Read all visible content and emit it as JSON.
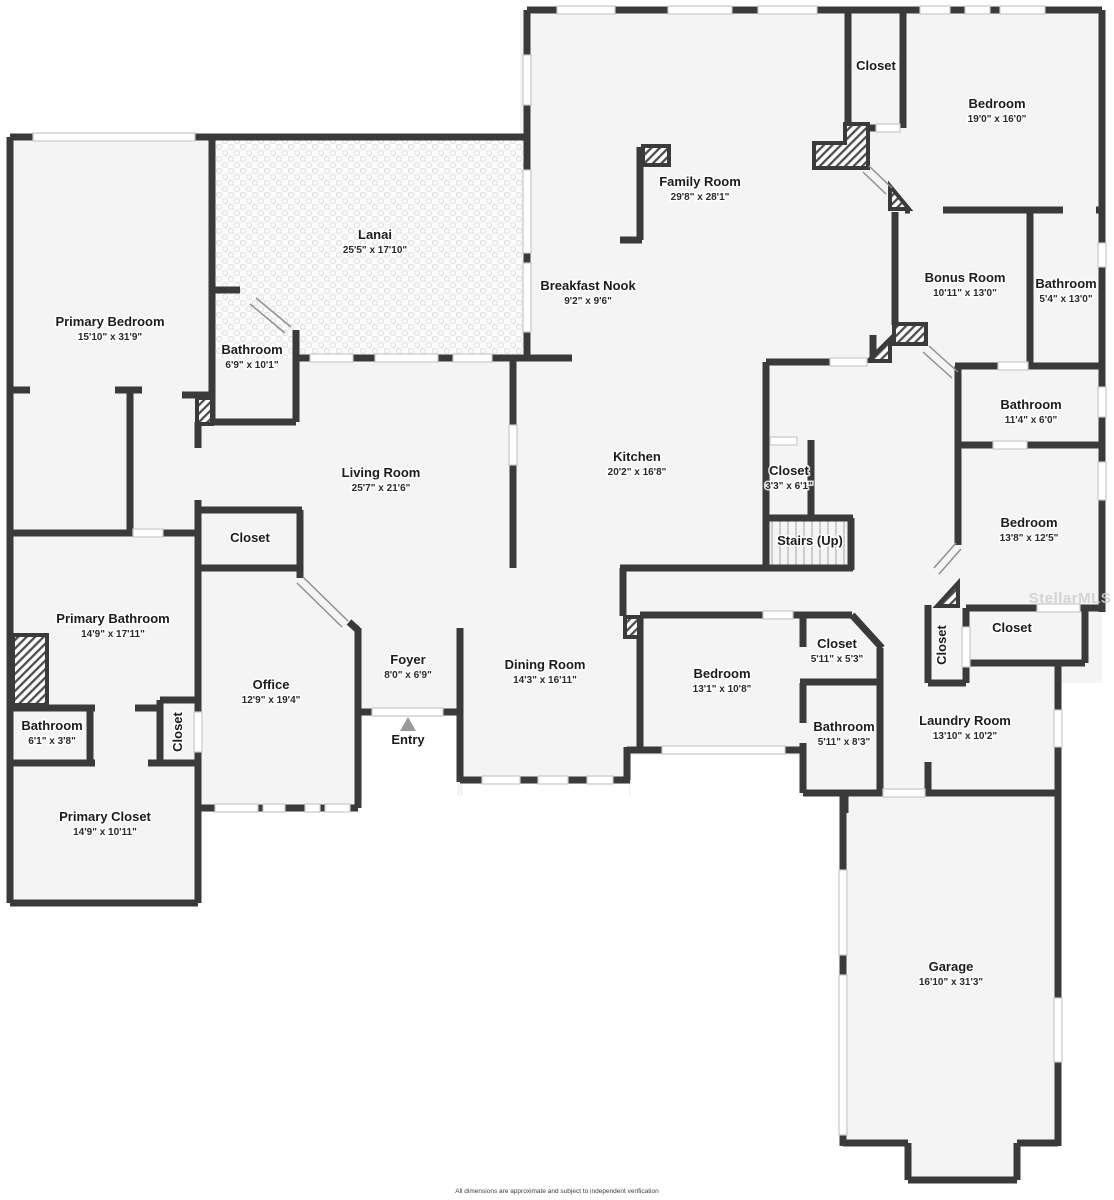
{
  "plan": {
    "wall_color": "#3a3a3a",
    "room_fill": "#f4f4f4",
    "label_color": "#1c1c1c",
    "window_color": "#c8c8c8",
    "entry_arrow_color": "#9a9a9a"
  },
  "rooms": [
    {
      "id": "lanai",
      "name": "Lanai",
      "dims": "25'5\" x 17'10\"",
      "x": 375,
      "y": 239
    },
    {
      "id": "primary-bedroom",
      "name": "Primary Bedroom",
      "dims": "15'10\" x 31'9\"",
      "x": 110,
      "y": 326
    },
    {
      "id": "bathroom-primary-hall",
      "name": "Bathroom",
      "dims": "6'9\" x 10'1\"",
      "x": 252,
      "y": 354
    },
    {
      "id": "family-room",
      "name": "Family Room",
      "dims": "29'8\" x 28'1\"",
      "x": 700,
      "y": 186
    },
    {
      "id": "closet-family",
      "name": "Closet",
      "dims": null,
      "x": 876,
      "y": 70
    },
    {
      "id": "bedroom-1",
      "name": "Bedroom",
      "dims": "19'0\" x 16'0\"",
      "x": 997,
      "y": 108
    },
    {
      "id": "breakfast-nook",
      "name": "Breakfast Nook",
      "dims": "9'2\" x 9'6\"",
      "x": 588,
      "y": 290
    },
    {
      "id": "bonus-room",
      "name": "Bonus Room",
      "dims": "10'11\" x 13'0\"",
      "x": 965,
      "y": 282
    },
    {
      "id": "bathroom-bonus",
      "name": "Bathroom",
      "dims": "5'4\" x 13'0\"",
      "x": 1066,
      "y": 288
    },
    {
      "id": "bathroom-hall",
      "name": "Bathroom",
      "dims": "11'4\" x 6'0\"",
      "x": 1031,
      "y": 409
    },
    {
      "id": "kitchen",
      "name": "Kitchen",
      "dims": "20'2\" x 16'8\"",
      "x": 637,
      "y": 461
    },
    {
      "id": "closet-kitchen",
      "name": "Closet",
      "dims": "3'3\" x 6'1\"",
      "x": 789,
      "y": 475
    },
    {
      "id": "stairs",
      "name": "Stairs (Up)",
      "dims": null,
      "x": 810,
      "y": 545
    },
    {
      "id": "bedroom-2",
      "name": "Bedroom",
      "dims": "13'8\" x 12'5\"",
      "x": 1029,
      "y": 527
    },
    {
      "id": "living-room",
      "name": "Living Room",
      "dims": "25'7\" x 21'6\"",
      "x": 381,
      "y": 477
    },
    {
      "id": "closet-living",
      "name": "Closet",
      "dims": null,
      "x": 250,
      "y": 542
    },
    {
      "id": "primary-bathroom",
      "name": "Primary Bathroom",
      "dims": "14'9\" x 17'11\"",
      "x": 113,
      "y": 623
    },
    {
      "id": "office",
      "name": "Office",
      "dims": "12'9\" x 19'4\"",
      "x": 271,
      "y": 689
    },
    {
      "id": "foyer",
      "name": "Foyer",
      "dims": "8'0\" x 6'9\"",
      "x": 408,
      "y": 664
    },
    {
      "id": "dining-room",
      "name": "Dining Room",
      "dims": "14'3\" x 16'11\"",
      "x": 545,
      "y": 669
    },
    {
      "id": "bedroom-3",
      "name": "Bedroom",
      "dims": "13'1\" x 10'8\"",
      "x": 722,
      "y": 678
    },
    {
      "id": "closet-bedroom-3",
      "name": "Closet",
      "dims": "5'11\" x 5'3\"",
      "x": 837,
      "y": 648
    },
    {
      "id": "closet-hall-vertical",
      "name": "Closet",
      "dims": null,
      "x": 946,
      "y": 645,
      "rotate": -90
    },
    {
      "id": "closet-hall",
      "name": "Closet",
      "dims": null,
      "x": 1012,
      "y": 632
    },
    {
      "id": "bathroom-primary-2",
      "name": "Bathroom",
      "dims": "6'1\" x 3'8\"",
      "x": 52,
      "y": 730
    },
    {
      "id": "closet-office-vertical",
      "name": "Closet",
      "dims": null,
      "x": 182,
      "y": 732,
      "rotate": -90
    },
    {
      "id": "primary-closet",
      "name": "Primary Closet",
      "dims": "14'9\" x 10'11\"",
      "x": 105,
      "y": 821
    },
    {
      "id": "entry",
      "name": "Entry",
      "dims": null,
      "x": 408,
      "y": 744
    },
    {
      "id": "bathroom-3",
      "name": "Bathroom",
      "dims": "5'11\" x 8'3\"",
      "x": 844,
      "y": 731
    },
    {
      "id": "laundry-room",
      "name": "Laundry Room",
      "dims": "13'10\" x 10'2\"",
      "x": 965,
      "y": 725
    },
    {
      "id": "garage",
      "name": "Garage",
      "dims": "16'10\" x 31'3\"",
      "x": 951,
      "y": 971
    }
  ],
  "watermark": {
    "text": "StellarMLS"
  },
  "footer": {
    "disclaimer": "All dimensions are approximate and subject to independent verification"
  }
}
